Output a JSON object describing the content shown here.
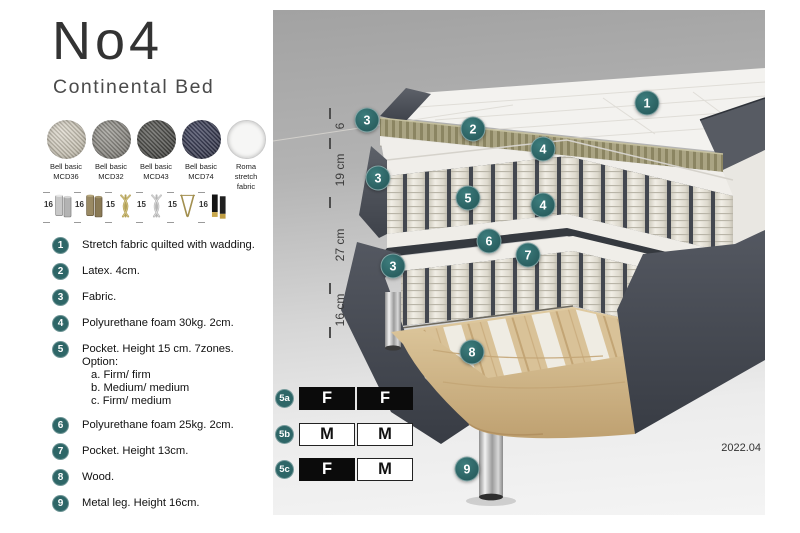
{
  "header": {
    "title": "No4",
    "subtitle": "Continental Bed"
  },
  "fabrics": [
    {
      "name": "Bell basic",
      "code": "MCD36",
      "color": "#ddd8cc",
      "dark": "#b3ad9d"
    },
    {
      "name": "Bell basic",
      "code": "MCD32",
      "color": "#a09e98",
      "dark": "#716f69"
    },
    {
      "name": "Bell basic",
      "code": "MCD43",
      "color": "#61615d",
      "dark": "#3b3b38"
    },
    {
      "name": "Bell basic",
      "code": "MCD74",
      "color": "#474a63",
      "dark": "#2b2d40"
    },
    {
      "name": "Roma",
      "code": "stretch fabric",
      "color": "#f6f6f5",
      "dark": "#dcdcdc"
    }
  ],
  "legs": [
    {
      "height": "16",
      "type": "cylinder-silver"
    },
    {
      "height": "16",
      "type": "cylinder-bronze"
    },
    {
      "height": "15",
      "type": "twist-gold"
    },
    {
      "height": "15",
      "type": "twist-silver"
    },
    {
      "height": "15",
      "type": "hairpin-gold"
    },
    {
      "height": "16",
      "type": "black-gold"
    }
  ],
  "features": [
    {
      "num": "1",
      "text": "Stretch fabric quilted with wadding."
    },
    {
      "num": "2",
      "text": "Latex. 4cm."
    },
    {
      "num": "3",
      "text": "Fabric."
    },
    {
      "num": "4",
      "text": "Polyurethane foam 30kg. 2cm."
    },
    {
      "num": "5",
      "text": "Pocket. Height 15 cm. 7zones. Option:",
      "options": [
        "a. Firm/ firm",
        "b. Medium/ medium",
        "c. Firm/ medium"
      ]
    },
    {
      "num": "6",
      "text": "Polyurethane foam 25kg. 2cm."
    },
    {
      "num": "7",
      "text": "Pocket. Height 13cm."
    },
    {
      "num": "8",
      "text": "Wood."
    },
    {
      "num": "9",
      "text": "Metal leg. Height 16cm."
    }
  ],
  "diagram": {
    "version": "2022.04",
    "accent_color": "#2e6667",
    "measurements": [
      {
        "label": "6",
        "y": 116
      },
      {
        "label": "19 cm",
        "y": 160
      },
      {
        "label": "27 cm",
        "y": 235
      },
      {
        "label": "16 cm",
        "y": 300
      }
    ],
    "tick_ys": [
      103,
      133,
      192,
      278,
      322
    ],
    "callouts": [
      {
        "label": "1",
        "x": 374,
        "y": 93
      },
      {
        "label": "2",
        "x": 200,
        "y": 119
      },
      {
        "label": "3",
        "x": 94,
        "y": 110
      },
      {
        "label": "3",
        "x": 105,
        "y": 168
      },
      {
        "label": "3",
        "x": 120,
        "y": 256
      },
      {
        "label": "4",
        "x": 270,
        "y": 139
      },
      {
        "label": "4",
        "x": 270,
        "y": 195
      },
      {
        "label": "5",
        "x": 195,
        "y": 188
      },
      {
        "label": "6",
        "x": 216,
        "y": 231
      },
      {
        "label": "7",
        "x": 255,
        "y": 245
      },
      {
        "label": "8",
        "x": 199,
        "y": 342
      },
      {
        "label": "9",
        "x": 194,
        "y": 459
      }
    ],
    "firmness_options": [
      {
        "id": "5a",
        "y": 377,
        "cells": [
          {
            "letter": "F",
            "style": "dark"
          },
          {
            "letter": "F",
            "style": "dark"
          }
        ]
      },
      {
        "id": "5b",
        "y": 413,
        "cells": [
          {
            "letter": "M",
            "style": "light"
          },
          {
            "letter": "M",
            "style": "light"
          }
        ]
      },
      {
        "id": "5c",
        "y": 448,
        "cells": [
          {
            "letter": "F",
            "style": "dark"
          },
          {
            "letter": "M",
            "style": "light"
          }
        ]
      }
    ]
  }
}
